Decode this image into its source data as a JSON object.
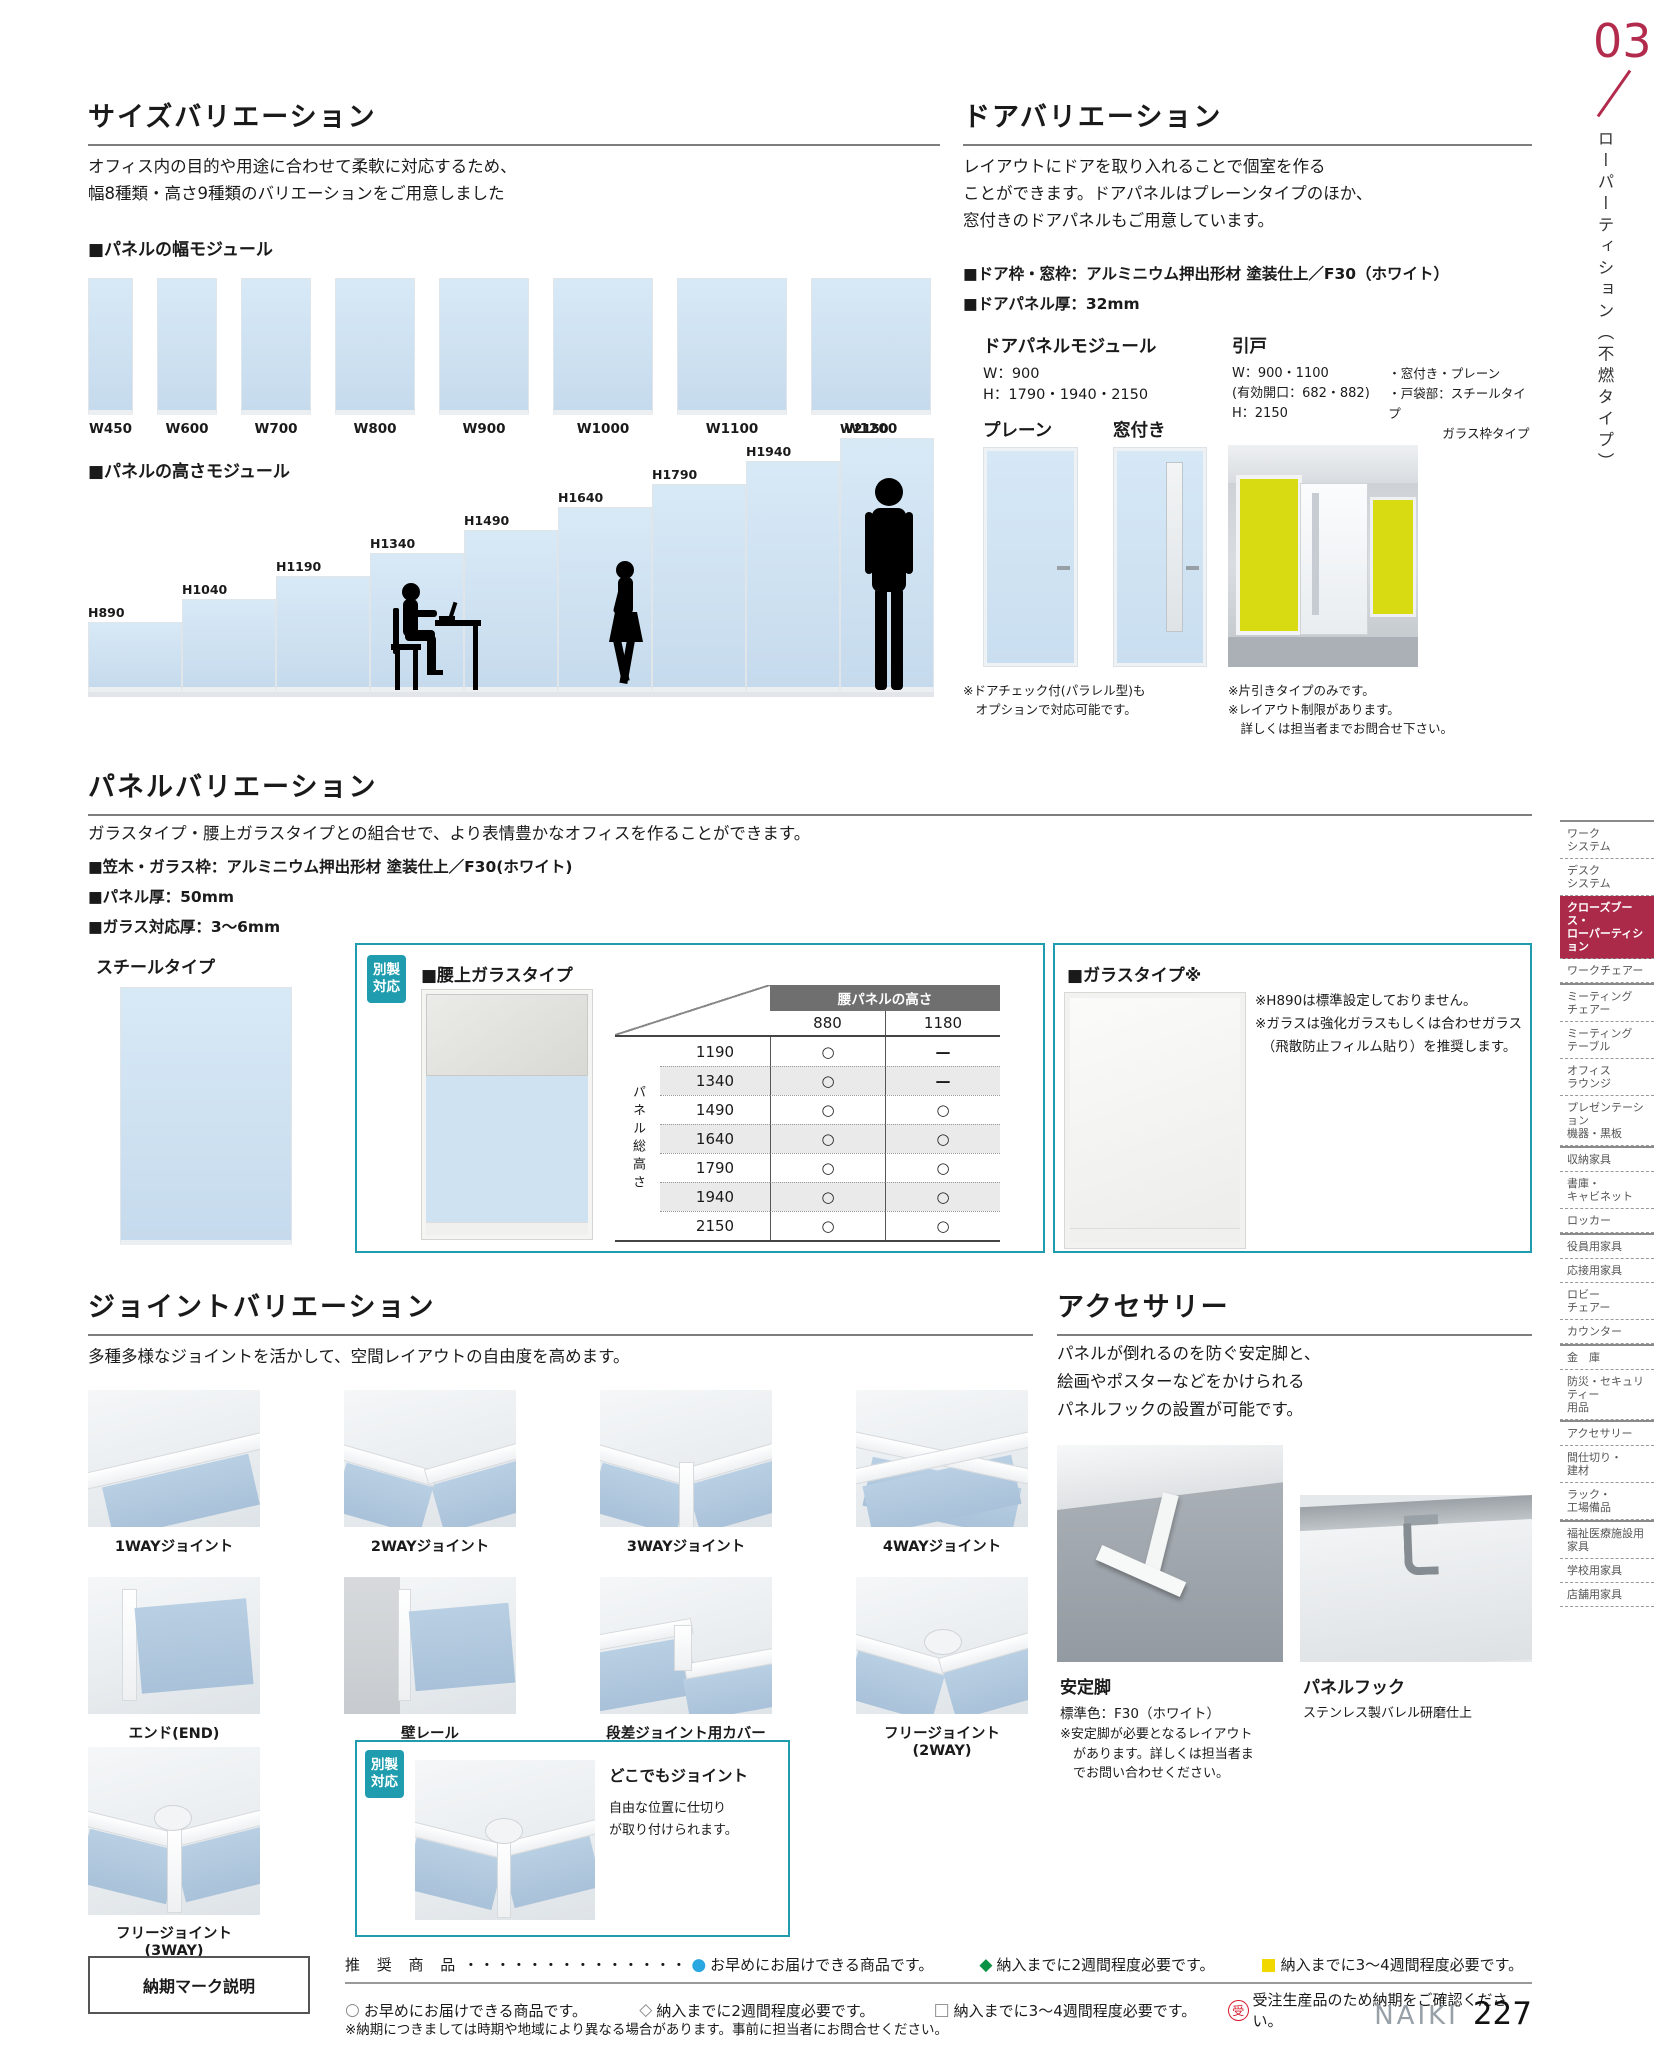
{
  "colors": {
    "accent_teal": "#1f9daf",
    "tab_crimson": "#b22b4c",
    "panel_blue": "#cfe2f1",
    "legend_blue": "#29a7e1",
    "legend_green": "#0a9344",
    "legend_yellow": "#f0d800",
    "legend_red": "#d7182a"
  },
  "page": {
    "tab_number": "03",
    "tab_title": "ローパーティション（不燃タイプ）",
    "brand": "NAIKI",
    "page_number": "227"
  },
  "size_variation": {
    "title": "サイズバリエーション",
    "desc": "オフィス内の目的や用途に合わせて柔軟に対応するため、\n幅8種類・高さ9種類のバリエーションをご用意しました",
    "width_module_label": "■パネルの幅モジュール",
    "width_labels": [
      "W450",
      "W600",
      "W700",
      "W800",
      "W900",
      "W1000",
      "W1100",
      "W1200"
    ],
    "height_module_label": "■パネルの高さモジュール",
    "height_labels": [
      "H890",
      "H1040",
      "H1190",
      "H1340",
      "H1490",
      "H1640",
      "H1790",
      "H1940",
      "W2150"
    ]
  },
  "door_variation": {
    "title": "ドアバリエーション",
    "desc": "レイアウトにドアを取り入れることで個室を作る\nことができます。ドアパネルはプレーンタイプのほか、\n窓付きのドアパネルもご用意しています。",
    "spec1": "■ドア枠・窓枠：アルミニウム押出形材 塗装仕上／F30（ホワイト）",
    "spec2": "■ドアパネル厚：32mm",
    "module_title": "ドアパネルモジュール",
    "module_spec": "W：900\nH：1790・1940・2150",
    "sliding_title": "引戸",
    "sliding_spec_left": "W：900・1100\n(有効開口：682・882)\nH：2150",
    "sliding_spec_right": "・窓付き・プレーン\n・戸袋部：スチールタイプ\n　　　　 ガラス枠タイプ",
    "plain_label": "プレーン",
    "window_label": "窓付き",
    "note_left": "※ドアチェック付(パラレル型)も\n　オプションで対応可能です。",
    "note_right": "※片引きタイプのみです。\n※レイアウト制限があります。\n　詳しくは担当者までお問合せ下さい。"
  },
  "panel_variation": {
    "title": "パネルバリエーション",
    "desc": "ガラスタイプ・腰上ガラスタイプとの組合せで、より表情豊かなオフィスを作ることができます。",
    "spec1": "■笠木・ガラス枠：アルミニウム押出形材 塗装仕上／F30(ホワイト)",
    "spec2": "■パネル厚：50mm",
    "spec3": "■ガラス対応厚：3～6mm",
    "steel_label": "スチールタイプ",
    "badge": "別製\n対応",
    "waist_glass_title": "■腰上ガラスタイプ",
    "glass_title": "■ガラスタイプ※",
    "glass_notes": "※H890は標準設定しておりません。\n※ガラスは強化ガラスもしくは合わせガラス\n　（飛散防止フィルム貼り）を推奨します。"
  },
  "panel_table": {
    "col_header": "腰パネルの高さ",
    "row_header": "パネル総高さ",
    "columns": [
      "880",
      "1180"
    ],
    "rows": [
      {
        "h": "1190",
        "c1": "○",
        "c2": "—"
      },
      {
        "h": "1340",
        "c1": "○",
        "c2": "—"
      },
      {
        "h": "1490",
        "c1": "○",
        "c2": "○"
      },
      {
        "h": "1640",
        "c1": "○",
        "c2": "○"
      },
      {
        "h": "1790",
        "c1": "○",
        "c2": "○"
      },
      {
        "h": "1940",
        "c1": "○",
        "c2": "○"
      },
      {
        "h": "2150",
        "c1": "○",
        "c2": "○"
      }
    ]
  },
  "joint_variation": {
    "title": "ジョイントバリエーション",
    "desc": "多種多様なジョイントを活かして、空間レイアウトの自由度を高めます。",
    "labels_row1": [
      "1WAYジョイント",
      "2WAYジョイント",
      "3WAYジョイント",
      "4WAYジョイント"
    ],
    "labels_row2": [
      "エンド(END)",
      "壁レール",
      "段差ジョイント用カバー",
      "フリージョイント(2WAY)"
    ],
    "label_row3": "フリージョイント(3WAY)",
    "dokodemo_badge": "別製\n対応",
    "dokodemo_title": "どこでもジョイント",
    "dokodemo_desc": "自由な位置に仕切り\nが取り付けられます。"
  },
  "accessories": {
    "title": "アクセサリー",
    "desc": "パネルが倒れるのを防ぐ安定脚と、\n絵画やポスターなどをかけられる\nパネルフックの設置が可能です。",
    "stab_title": "安定脚",
    "stab_color": "標準色：F30（ホワイト）",
    "stab_notes": "※安定脚が必要となるレイアウト\n　があります。詳しくは担当者ま\n　でお問い合わせください。",
    "hook_title": "パネルフック",
    "hook_desc": "ステンレス製バレル研磨仕上"
  },
  "footer": {
    "box_label": "納期マーク説明",
    "line1_label": "推 奨 商 品",
    "dots": "・・・・・・・・・・・・・・",
    "marks": {
      "blue": "●",
      "green": "◆",
      "yellow": "■",
      "circle": "○",
      "diamond": "◇",
      "square": "□",
      "jyu": "受"
    },
    "legend1": [
      {
        "text": "お早めにお届けできる商品です。"
      },
      {
        "text": "納入までに2週間程度必要です。"
      },
      {
        "text": "納入までに3～4週間程度必要です。"
      }
    ],
    "legend2": [
      {
        "text": "お早めにお届けできる商品です。"
      },
      {
        "text": "納入までに2週間程度必要です。"
      },
      {
        "text": "納入までに3～4週間程度必要です。"
      },
      {
        "text": "受注生産品のため納期をご確認ください。"
      }
    ],
    "note": "※納期につきましては時期や地域により異なる場合があります。事前に担当者にお問合せください。"
  },
  "sidebar": {
    "items": [
      {
        "label": "ワーク\nシステム"
      },
      {
        "label": "デスク\nシステム"
      },
      {
        "label": "クローズブース・\nローパーティション"
      },
      {
        "label": "ワークチェアー"
      },
      {
        "label": "ミーティング\nチェアー"
      },
      {
        "label": "ミーティング\nテーブル"
      },
      {
        "label": "オフィス\nラウンジ"
      },
      {
        "label": "プレゼンテーション\n機器・黒板"
      },
      {
        "label": "収納家具"
      },
      {
        "label": "書庫・\nキャビネット"
      },
      {
        "label": "ロッカー"
      },
      {
        "label": "役員用家具"
      },
      {
        "label": "応接用家具"
      },
      {
        "label": "ロビー\nチェアー"
      },
      {
        "label": "カウンター"
      },
      {
        "label": "金　庫"
      },
      {
        "label": "防災・セキュリティー\n用品"
      },
      {
        "label": "アクセサリー"
      },
      {
        "label": "間仕切り・\n建材"
      },
      {
        "label": "ラック・\n工場備品"
      },
      {
        "label": "福祉医療施設用\n家具"
      },
      {
        "label": "学校用家具"
      },
      {
        "label": "店舗用家具"
      }
    ]
  }
}
